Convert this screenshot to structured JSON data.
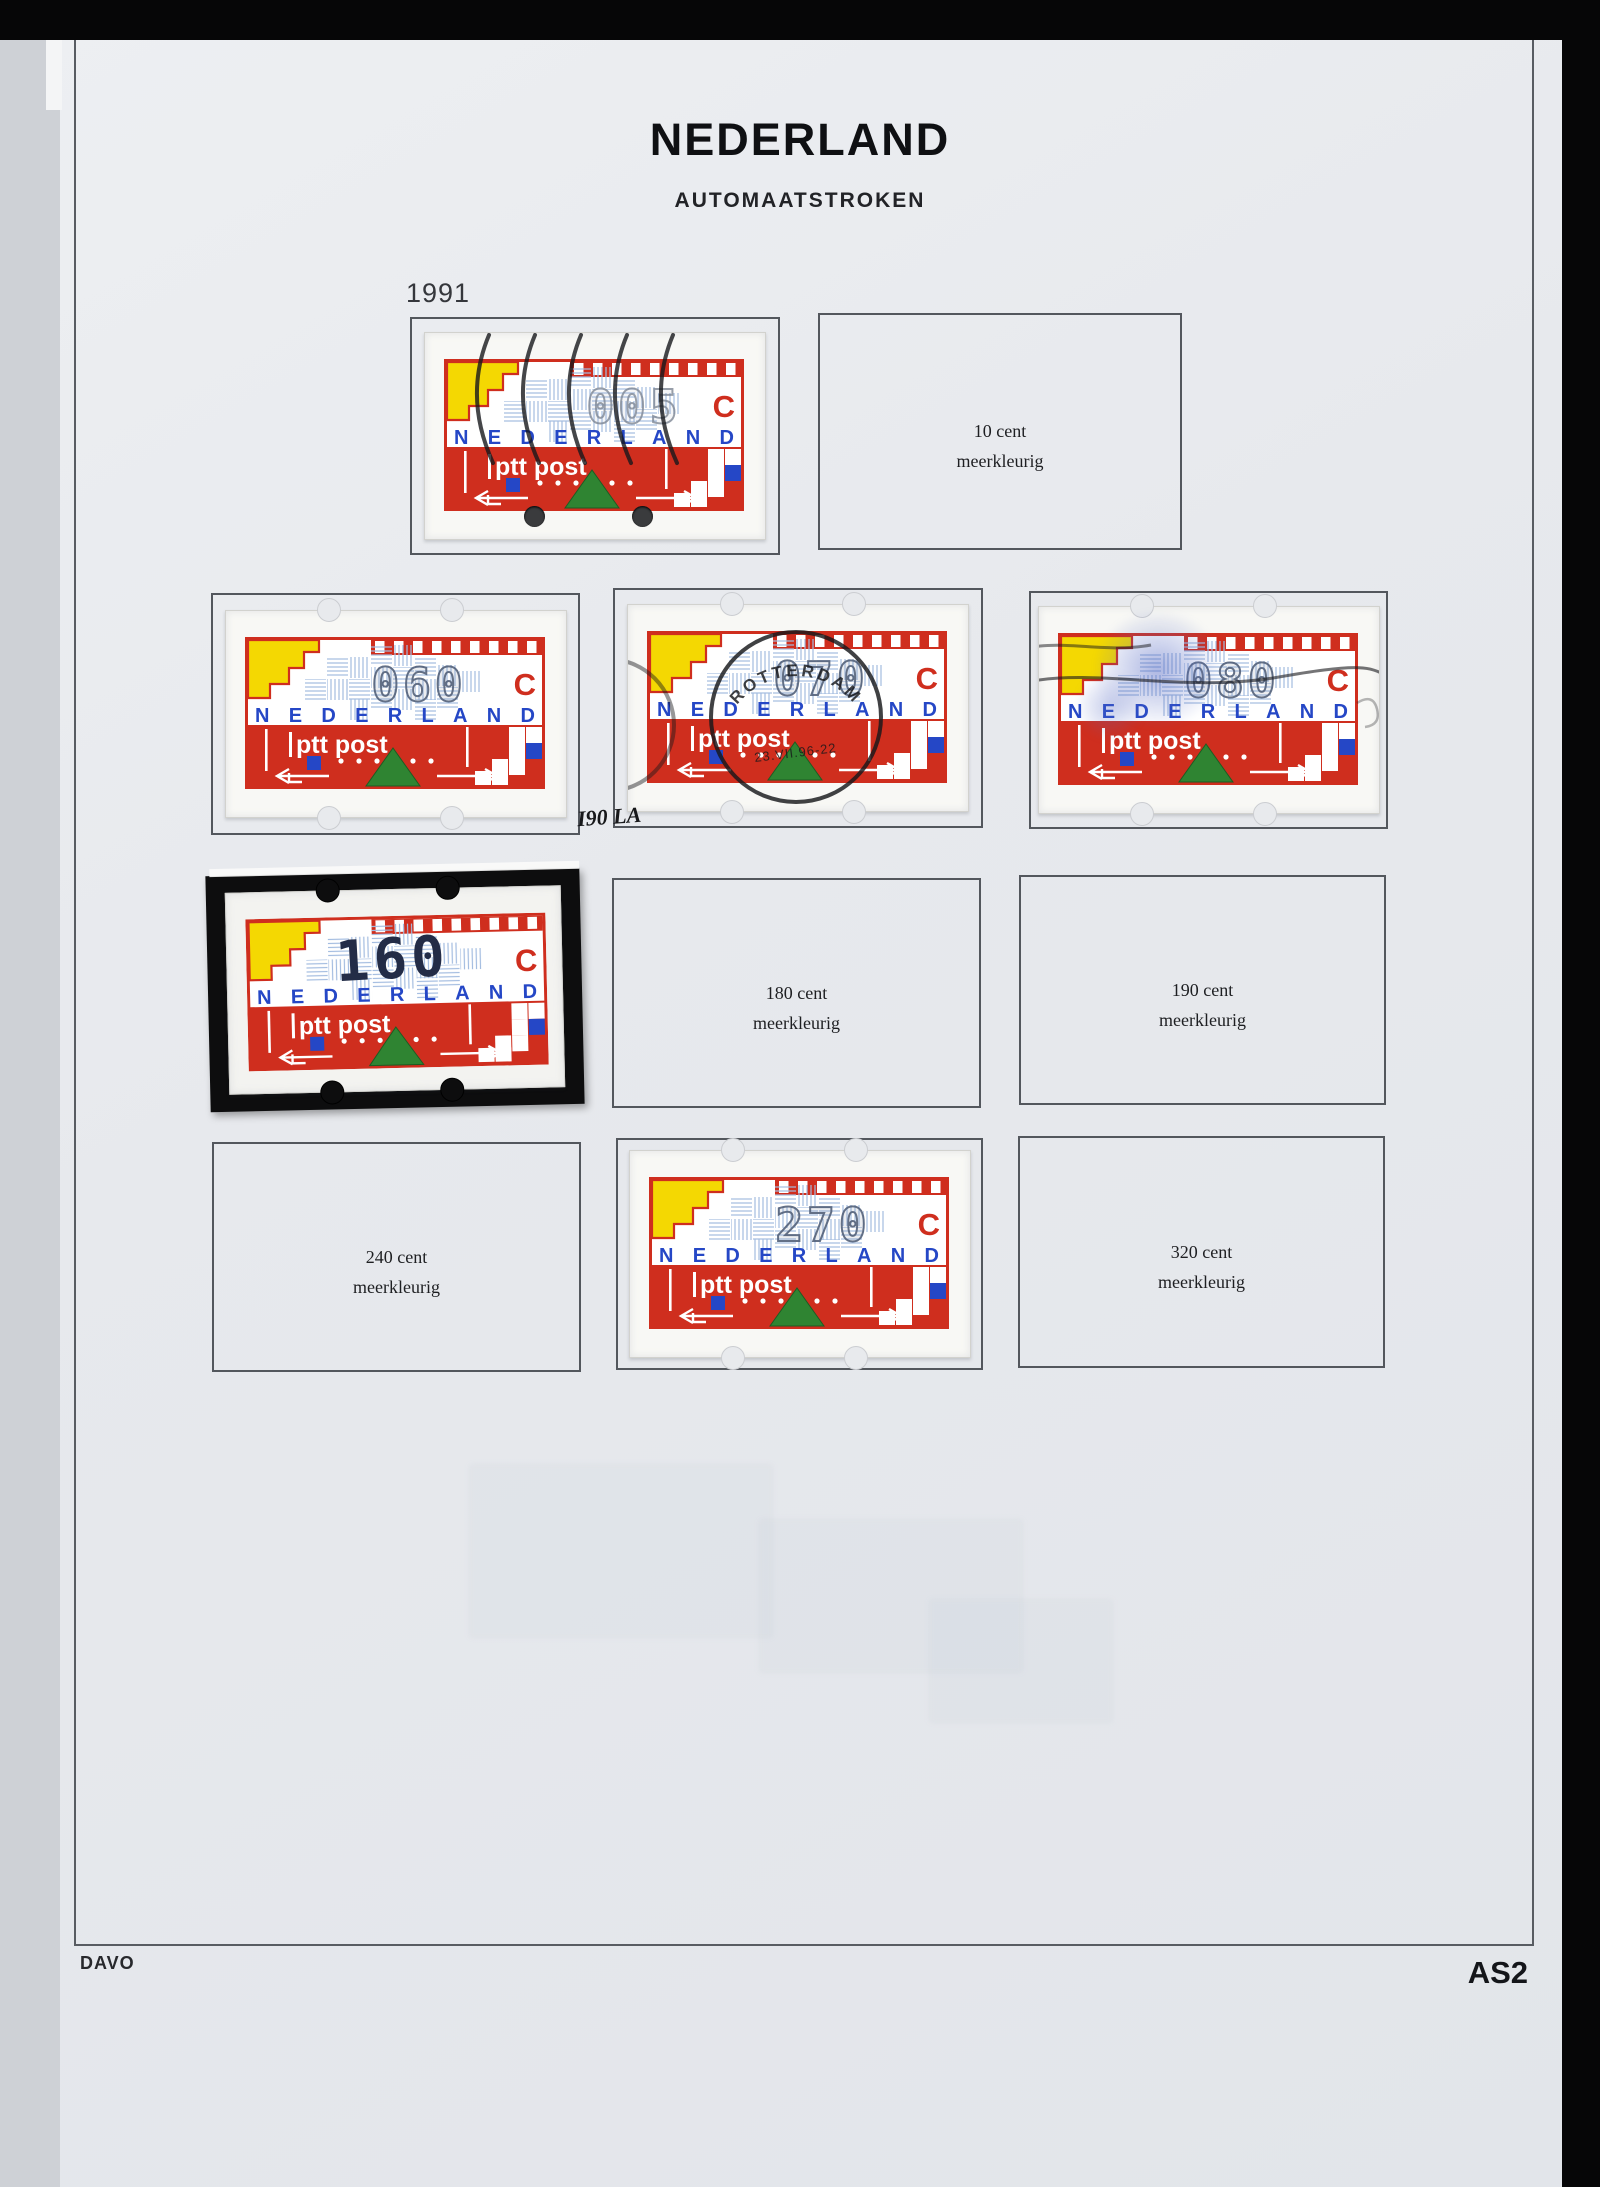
{
  "page": {
    "title": "NEDERLAND",
    "subtitle": "AUTOMAATSTROKEN",
    "year_label": "1991",
    "publisher": "DAVO",
    "page_code": "AS2"
  },
  "stamp_design": {
    "country_text": "NEDERLAND",
    "carrier_text": "ptt post",
    "currency_letter": "C"
  },
  "colors": {
    "page_bg": "#e8eaed",
    "stamp_red": "#cf2e1e",
    "stamp_yellow": "#f4d802",
    "stamp_blue": "#2547c6",
    "hatch_blue": "#a3bce0",
    "triangle_green": "#2f8432",
    "mount_black": "#0d0d0e",
    "value_grey": "#53617a",
    "cancel_black": "#17181b"
  },
  "cells": [
    {
      "type": "stamp",
      "value": "005",
      "cancel": "wavy",
      "holes": true
    },
    {
      "type": "label",
      "line1": "10 cent",
      "line2": "meerkleurig"
    },
    {
      "type": "stamp",
      "value": "060"
    },
    {
      "type": "stamp",
      "value": "070",
      "postmark": {
        "town": "ROTTERDAM",
        "date": "23.VII.96-22"
      },
      "annotation": "I90 LA"
    },
    {
      "type": "stamp",
      "value": "080",
      "smudge": true,
      "cancel": "lines"
    },
    {
      "type": "stamp",
      "value": "160",
      "mount": true
    },
    {
      "type": "label",
      "line1": "180 cent",
      "line2": "meerkleurig"
    },
    {
      "type": "label",
      "line1": "190 cent",
      "line2": "meerkleurig"
    },
    {
      "type": "label",
      "line1": "240 cent",
      "line2": "meerkleurig"
    },
    {
      "type": "stamp",
      "value": "270"
    },
    {
      "type": "label",
      "line1": "320 cent",
      "line2": "meerkleurig"
    }
  ]
}
